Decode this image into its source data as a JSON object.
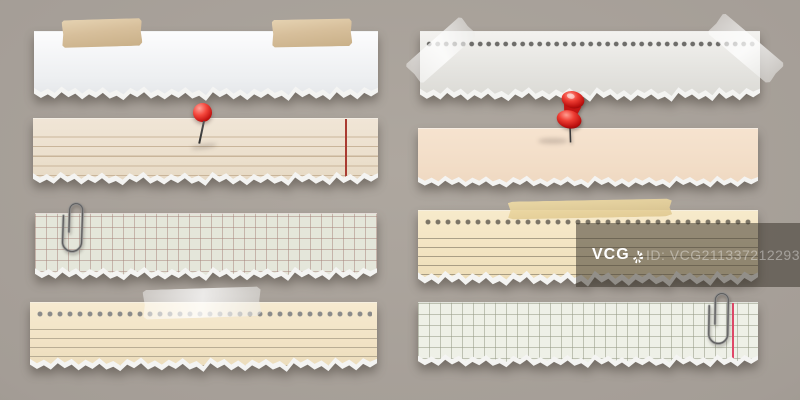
{
  "image": {
    "type": "stock-illustration",
    "subject": "Eight torn ripped paper strips attached to a gray wall with tape, pins and paperclips",
    "background_color": "#a49d96"
  },
  "watermark": {
    "brand": "VCG",
    "id_text": "ID: VCG211337212293",
    "overlay_color": "rgba(56,49,41,0.52)"
  },
  "strips": [
    {
      "id": "white-plain-taped",
      "column": "left",
      "row": 1,
      "paper": "plain white torn strip",
      "paper_color": "#f4f5f6",
      "accessories": [
        "adhesive-tape-beige",
        "adhesive-tape-beige"
      ]
    },
    {
      "id": "cream-ruled-pinned",
      "column": "left",
      "row": 2,
      "paper": "cream ruled strip with red margin line",
      "paper_color": "#ece0cf",
      "rule_color": "#c9b59a",
      "margin_line_color": "#a93b31",
      "accessories": [
        "round-ball-pin-red"
      ]
    },
    {
      "id": "grid-paper-clipped",
      "column": "left",
      "row": 3,
      "paper": "squared grid strip",
      "paper_color": "#e4e6da",
      "grid_color": "#a5827a",
      "accessories": [
        "paperclip"
      ]
    },
    {
      "id": "tan-perforated-ruled-taped",
      "column": "left",
      "row": 4,
      "paper": "tan ruled strip with punch holes",
      "paper_color": "#f3e5ca",
      "hole_color": "#8a8a8a",
      "accessories": [
        "adhesive-tape-white"
      ]
    },
    {
      "id": "white-perforated-corner-taped",
      "column": "right",
      "row": 1,
      "paper": "light gray perforated notebook strip",
      "paper_color": "#ecebe8",
      "hole_color": "#6e6d6a",
      "accessories": [
        "adhesive-tape-white-corner",
        "adhesive-tape-white-corner"
      ]
    },
    {
      "id": "peach-plain-pushpinned",
      "column": "right",
      "row": 2,
      "paper": "plain peach torn strip",
      "paper_color": "#f3dfca",
      "accessories": [
        "push-pin-red"
      ]
    },
    {
      "id": "tan-perforated-ruled-taped-2",
      "column": "right",
      "row": 3,
      "paper": "tan ruled strip with punch holes",
      "paper_color": "#f4e6c7",
      "hole_color": "#7c7566",
      "accessories": [
        "adhesive-tape-yellow"
      ]
    },
    {
      "id": "grid-paper-clipped-2",
      "column": "right",
      "row": 4,
      "paper": "squared grid strip with pink margin line",
      "paper_color": "#eef0e7",
      "grid_color": "#9aa08c",
      "margin_line_color": "#e04868",
      "accessories": [
        "paperclip"
      ]
    }
  ]
}
